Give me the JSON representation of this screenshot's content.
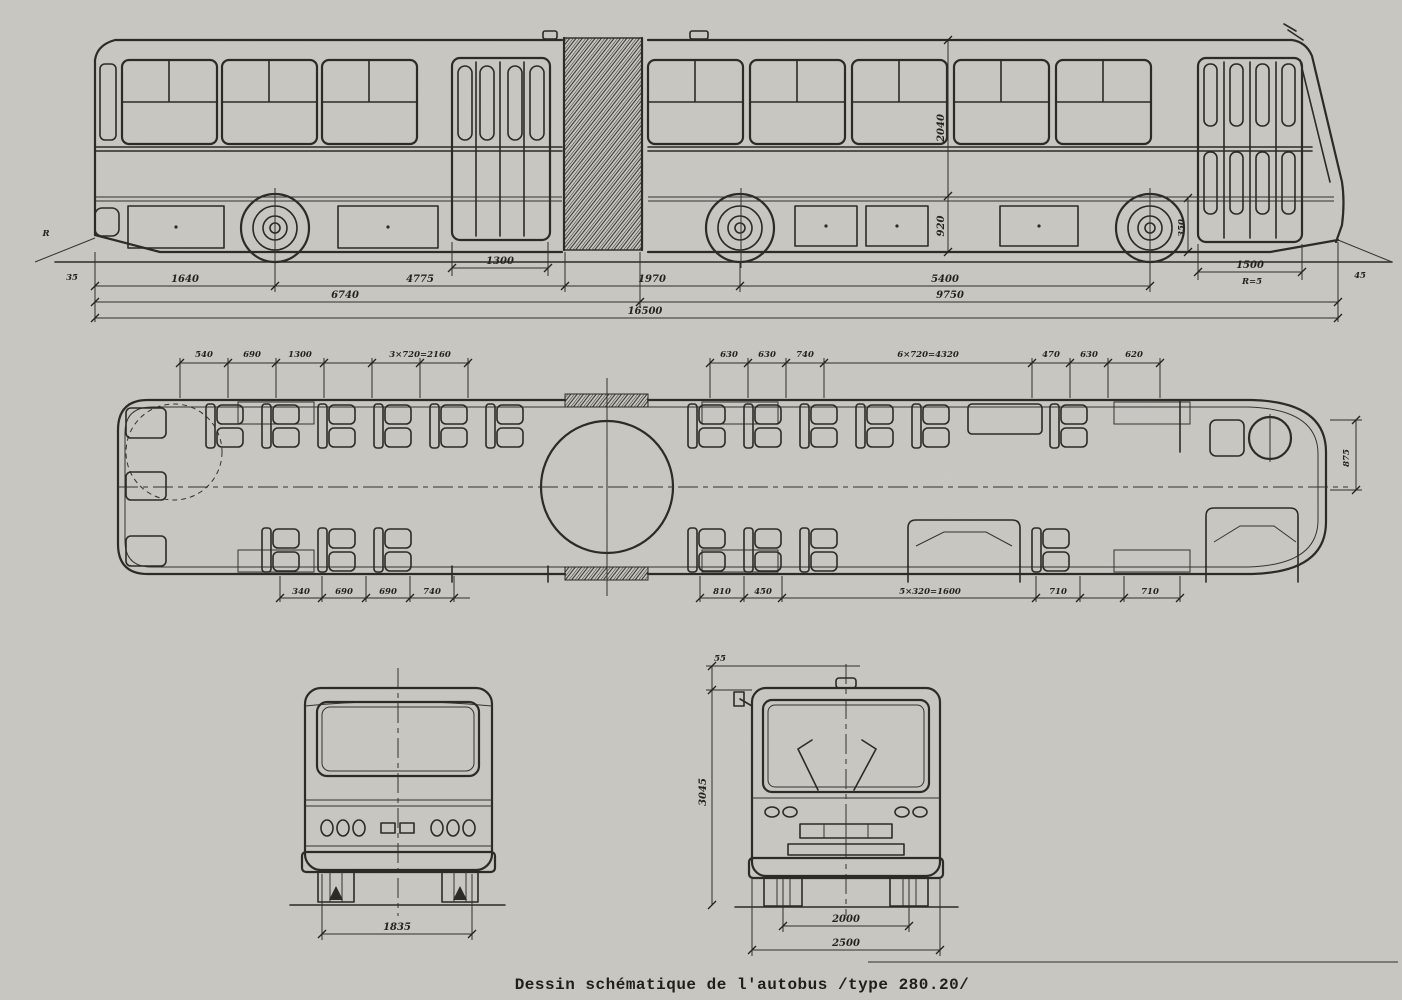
{
  "caption": "Dessin schématique de l'autobus /type 280.20/",
  "meta": {
    "ink_color": "#2c2b27",
    "paper_color": "#d8d6d1",
    "bus_type": "280.20"
  },
  "side_view": {
    "dims": {
      "door_rear_width": "1300",
      "door_front_width": "1500",
      "door_front_note": "R=5",
      "rear_overhang": "1640",
      "seg_rear": "4775",
      "seg_bellows": "1970",
      "seg_front_axles": "5400",
      "len_rear_section": "6740",
      "len_front_section": "9750",
      "len_total": "16500",
      "h_upper": "2040",
      "h_floor": "920",
      "h_front": "350",
      "angle_rear": "R",
      "tick_rear": "35",
      "tick_front": "45"
    }
  },
  "plan_view": {
    "dims_top": [
      "540",
      "690",
      "1300",
      "3×720=2160",
      "630",
      "630",
      "740",
      "6×720=4320",
      "470",
      "630",
      "620"
    ],
    "dims_bottom": [
      "340",
      "690",
      "690",
      "740",
      "810",
      "450",
      "5×320=1600",
      "710",
      "710"
    ],
    "dim_front_width": "875"
  },
  "rear_view": {
    "dims": {
      "track": "1835"
    }
  },
  "front_view": {
    "dims": {
      "roof_cap": "55",
      "height": "3045",
      "track": "2000",
      "width": "2500"
    }
  }
}
